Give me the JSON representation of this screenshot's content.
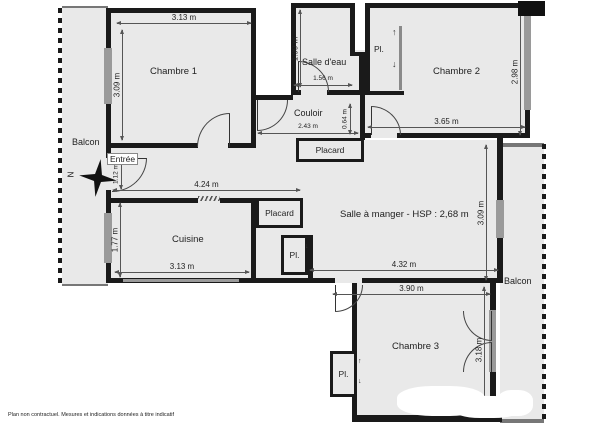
{
  "plan": {
    "rooms": {
      "chambre1": "Chambre 1",
      "salle_eau": "Salle d'eau",
      "chambre2": "Chambre 2",
      "couloir": "Couloir",
      "placard": "Placard",
      "pl": "Pl.",
      "entree": "Entrée",
      "balcon": "Balcon",
      "cuisine": "Cuisine",
      "salle_a_manger": "Salle à manger - HSP : 2,68 m",
      "chambre3": "Chambre 3"
    },
    "dims": {
      "chambre1_w": "3.13 m",
      "chambre1_h": "3.09 m",
      "salle_eau_h": "1.99 m",
      "salle_eau_w": "1.56 m",
      "chambre2_w": "3.65 m",
      "chambre2_h": "2.98 m",
      "couloir_w": "2.43 m",
      "couloir_h": "0.64 m",
      "entree_h": "1.12 m",
      "hall_w": "4.24 m",
      "cuisine_h": "1.77 m",
      "cuisine_w": "3.13 m",
      "sam_h": "3.09 m",
      "sam_w": "4.32 m",
      "chambre3_w": "3.90 m",
      "chambre3_h": "3.18 m"
    },
    "compass_north": "N",
    "icons": {
      "arrow_up": "↑",
      "arrow_down": "↓"
    },
    "disclaimer": "Plan non contractuel. Mesures et indications données à titre indicatif",
    "colors": {
      "wall": "#1a1a1a",
      "room_fill": "#e9e9e9",
      "window": "#9a9a9a",
      "dim_line": "#555555"
    }
  }
}
